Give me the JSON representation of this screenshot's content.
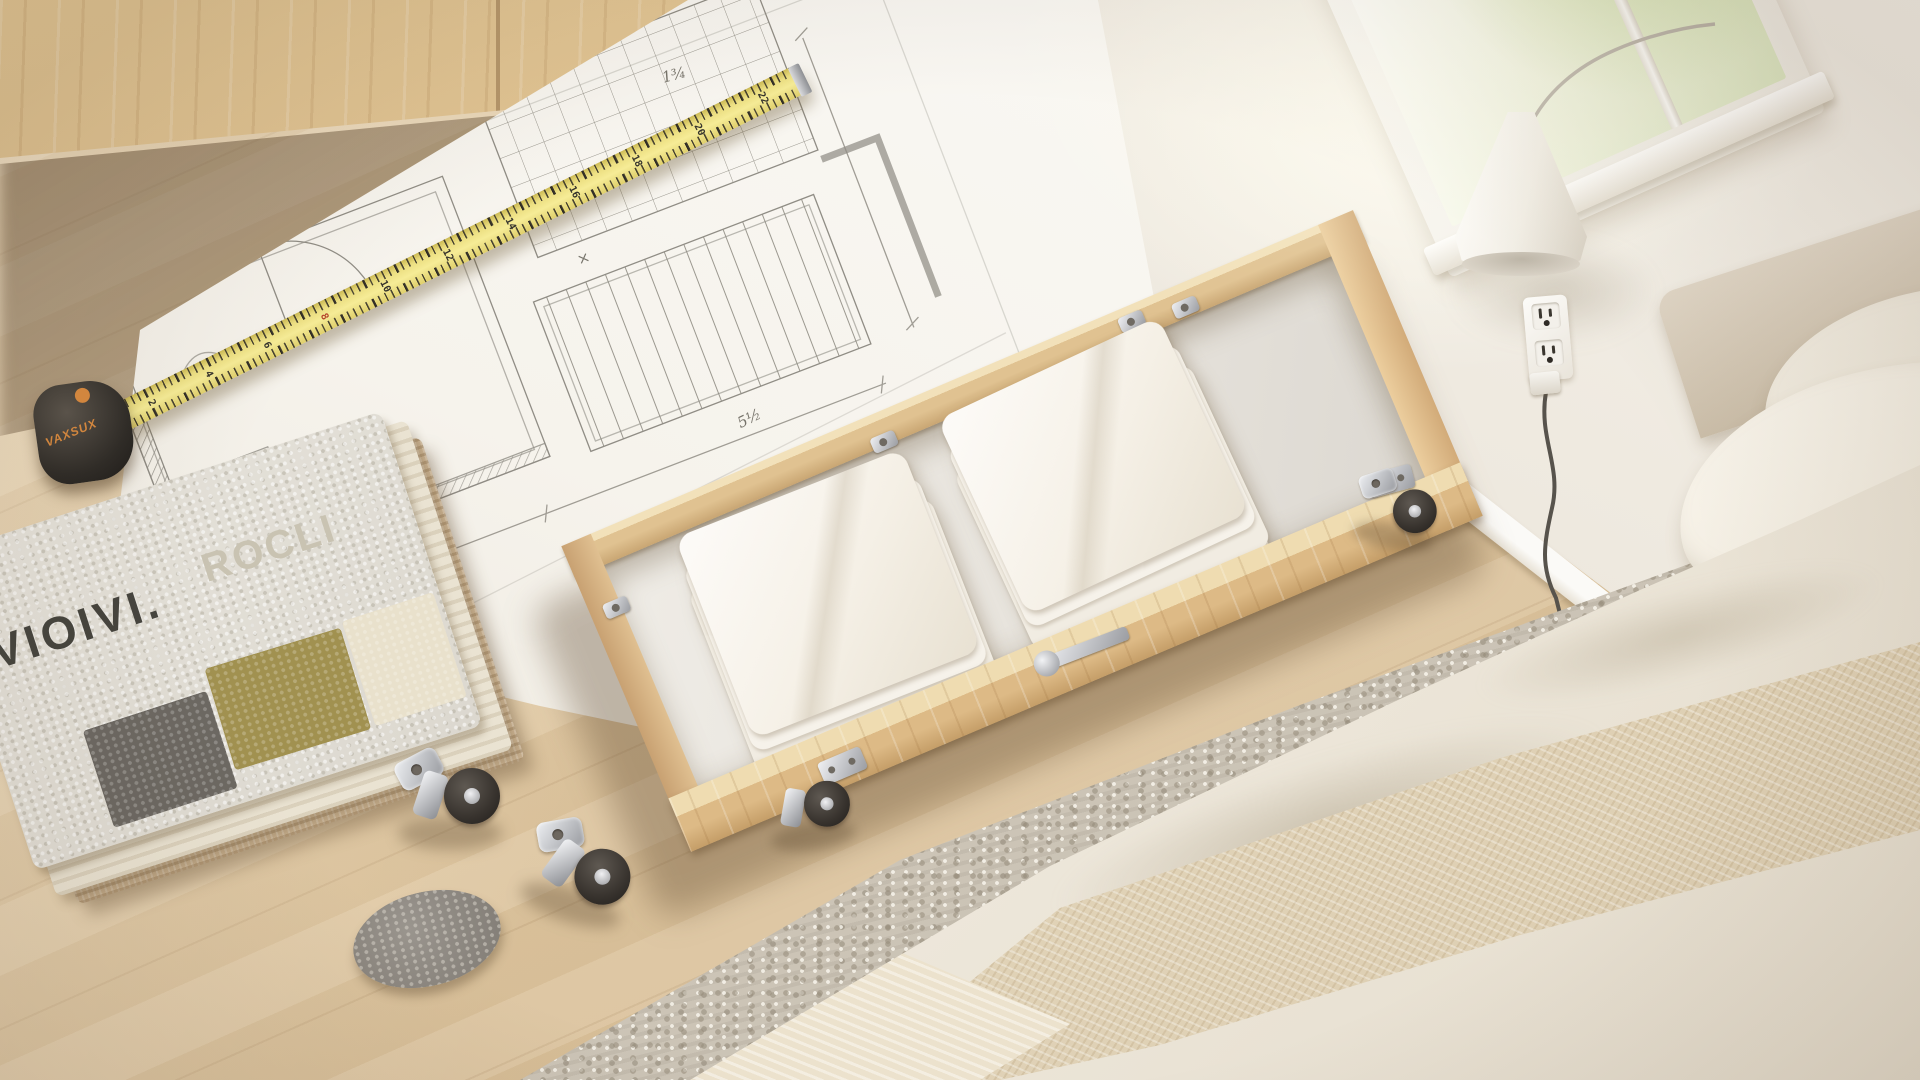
{
  "caption": "Photo of a wooden under-bed storage drawer with folded white linens, standing on a floor-plan blueprint with a tape measure, loose caster wheels, a felt pad and a carpet sample stack, next to a bed with beige bedding, a wall lamp, a power outlet and a window",
  "swatch": {
    "brand_text": "VIOIVI.",
    "ghost_text": "ROCLI"
  },
  "tape_measure": {
    "case_label": "VAXSUX",
    "numbers": [
      "2",
      "4",
      "6",
      "8",
      "10",
      "12",
      "14",
      "16",
      "18",
      "20",
      "22"
    ]
  },
  "blueprint": {
    "annotations": [
      "3¼",
      "≈2'8",
      "×",
      "1¾",
      "5½"
    ]
  },
  "colors": {
    "floor_wood": "#e0c9a4",
    "cabinet_wood": "#d9ba8e",
    "drawer_wood": "#ddba86",
    "drawer_interior": "#e8e4dd",
    "linen_white": "#f6f2ea",
    "paper_white": "#f7f4ee",
    "pencil_grey": "#908d85",
    "tape_yellow": "#eadd7f",
    "tape_case_black": "#2e2b27",
    "accent_orange": "#d98a3f",
    "tape_red_mark": "#b5432a",
    "wall_cream": "#ece6db",
    "baseboard_white": "#f9f8f4",
    "window_green": "#d5e3b5",
    "lamp_white": "#f4f1ea",
    "rug_grey": "#ccc5b8",
    "blanket_beige": "#e3d6bd",
    "pillow_cream": "#f1ece1",
    "swatch_grey_block": "#6c6862",
    "swatch_olive_block": "#a19150",
    "swatch_cream_block": "#e9e1cc",
    "jute_tan": "#c9b190",
    "felt_grey": "#8f8b84",
    "caster_wheel_rubber": "#46413c",
    "caster_metal": "#c9cacd"
  }
}
